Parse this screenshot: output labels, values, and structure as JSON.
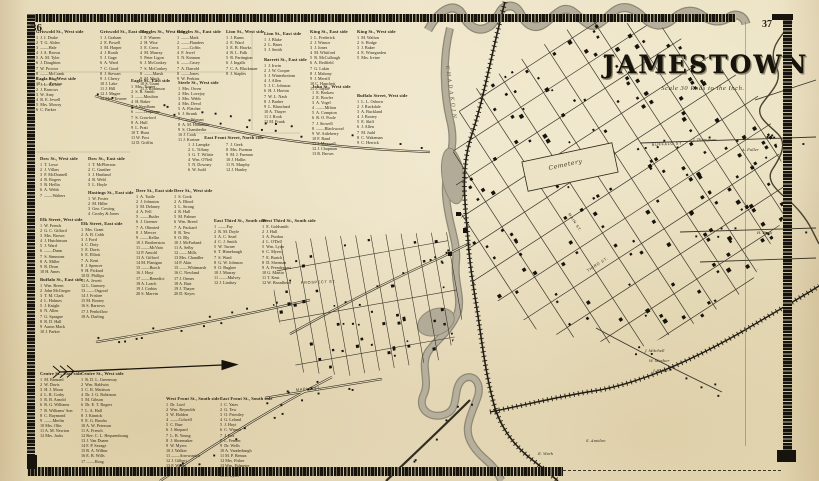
{
  "page": {
    "left_number": "36",
    "right_number": "37"
  },
  "title": {
    "text": "JAMESTOWN",
    "scale_note": "Scale 30 Rods to the Inch."
  },
  "map_labels": [
    {
      "text": "Cemetery",
      "x": 549,
      "y": 170,
      "rotate": -12,
      "cls": "cem"
    },
    {
      "text": "CHADAKOIN",
      "x": 446,
      "y": 66,
      "rotate": 82,
      "cls": "river"
    },
    {
      "text": "MAPLE  ST.",
      "x": 296,
      "y": 391,
      "rotate": -4,
      "cls": "street"
    },
    {
      "text": "PROSPECT  ST.",
      "x": 301,
      "y": 284,
      "rotate": -2,
      "cls": "street"
    },
    {
      "text": "MAIN  ST.",
      "x": 568,
      "y": 214,
      "rotate": 57,
      "cls": "street"
    },
    {
      "text": "THIRD  ST.",
      "x": 588,
      "y": 272,
      "rotate": -33,
      "cls": "street"
    },
    {
      "text": "BUFFALO  ST.",
      "x": 652,
      "y": 146,
      "rotate": -3,
      "cls": "street"
    }
  ],
  "settler_names": [
    {
      "text": "J. Thompson",
      "x": 693,
      "y": 141
    },
    {
      "text": "A. Fuller",
      "x": 742,
      "y": 151
    },
    {
      "text": "H. Bush",
      "x": 757,
      "y": 234
    },
    {
      "text": "J. Mitchell",
      "x": 645,
      "y": 352
    },
    {
      "text": "W. Mosher",
      "x": 649,
      "y": 362
    },
    {
      "text": "J. Baker",
      "x": 653,
      "y": 372
    },
    {
      "text": "S. Amidon",
      "x": 586,
      "y": 442
    },
    {
      "text": "E. Work",
      "x": 538,
      "y": 455
    }
  ],
  "directory": {
    "blocks": [
      {
        "header": "Griswold St., West side",
        "x": 36,
        "y": 29,
        "entries": [
          "1  J. J. Drake",
          "2  T. G. Alden",
          "3  ——Hale",
          "4  J. A. Brown",
          "5  A. M. Tyler",
          "6  J. Daughton",
          "7  W. Proctor",
          "8  ——McCrank",
          "9  ——King",
          "10 ——Preston"
        ]
      },
      {
        "header": "Griswold St., East side",
        "x": 100,
        "y": 29,
        "entries": [
          "1  J. Graham",
          "2  E. Powell",
          "3  M. Harper",
          "4  J. Roath",
          "5  J. Gage",
          "6  A. Ward",
          "7  C. Good",
          "8  J. Stewart",
          "9  J. Cherry",
          "10 J. Lake",
          "11 J. Hill",
          "12 J. Magee",
          "13 Mrs. Towner"
        ]
      },
      {
        "header": "Ruggles St., West side",
        "x": 140,
        "y": 29,
        "entries": [
          "1  F. Warren",
          "2  H. Wise",
          "3  E. Cross",
          "4  M. Murray",
          "5  Peter Ligon",
          "6  J. McConkey",
          "7  S. McConkey",
          "8  ——Marsh",
          "9  M. Mack",
          "10 S. Grant",
          "11 J. Robinson"
        ]
      },
      {
        "header": "Ruggles St., East side",
        "x": 177,
        "y": 29,
        "entries": [
          "1  ——Mark",
          "2  ——Flanders",
          "3  ——Coffin",
          "4  F. Jewel",
          "5  N. Kinman",
          "6  ——Casey",
          "7  A. Darrold",
          "8  ——Jones",
          "9  W. Perkins"
        ]
      },
      {
        "header": "Lion St., West side",
        "x": 226,
        "y": 29,
        "entries": [
          "1  J. Burns",
          "2  E. Ward",
          "3  E. B. Hawks",
          "4  R. L. Falk",
          "5  R. Partington",
          "6  J. Ingalls",
          "7  C. A. Blackmarr",
          "8  J. Staples"
        ]
      },
      {
        "header": "Lion St., East side",
        "x": 264,
        "y": 31,
        "entries": [
          "1  J. Blake",
          "2  L. Bates",
          "3  J. Smith"
        ]
      },
      {
        "header": "King St., East side",
        "x": 310,
        "y": 29,
        "entries": [
          "1  L. Frederick",
          "2  J. Winsor",
          "3  J. Jones",
          "4  M. Whitford",
          "5  R. McCullough",
          "6  A. Redfield",
          "7  G. Lakin",
          "8  J. Mahony",
          "9  J. Merrill",
          "10 C. Hanchett",
          "11 J. Taylor"
        ]
      },
      {
        "header": "King St., West side",
        "x": 357,
        "y": 29,
        "entries": [
          "1  M. Walton",
          "2  S. Hodge",
          "3  J. Baker",
          "4  E. Winegarden",
          "5  Mrs. Irvine"
        ]
      },
      {
        "header": "Eagle St., West side",
        "x": 36,
        "y": 76,
        "entries": [
          "1  J. L. Barlow",
          "2  J. Barrows",
          "3  W. Amy",
          "4  R. E. Jewell",
          "5  Mrs. Mowry",
          "6  C. Parker"
        ]
      },
      {
        "header": "Eagle St., East side",
        "x": 131,
        "y": 78,
        "entries": [
          "1  Mrs. Turner",
          "2  S. B. Smith",
          "3  ——Moulton",
          "4  H. Baker",
          "5  J. Needham",
          "6  ——Tenpenny",
          "7  S. Crawford",
          "8  A. Hull",
          "9  L. Pratt",
          "10 T. Hunt",
          "11 W. Post",
          "12 D. Griffin"
        ]
      },
      {
        "header": "Steele St., West side",
        "x": 178,
        "y": 80,
        "entries": [
          "1  Mrs. Owen",
          "2  Mrs. Lovejoy",
          "3  Mrs. Webb",
          "4  Mrs. Devol",
          "5  A. Fletcher",
          "6  J. Strunk",
          "7  ——Wyman",
          "8  A. M. Hamilton",
          "9  S. Chamberlin",
          "10 J. Cook",
          "11 J. Kortner"
        ]
      },
      {
        "header": "Barrett St., East side",
        "x": 264,
        "y": 57,
        "entries": [
          "1  J. Irwin",
          "2  J. W. Cooper",
          "3  J. Winterbottom",
          "4  J. Allen",
          "5  J. C. Johnson",
          "6  H. J. Horton",
          "7  W. L. Nash",
          "8  J. Barber",
          "9  L. Blanchard",
          "10 A. Thayer",
          "11 J. Rook",
          "12 M. Frank"
        ]
      },
      {
        "header": "John St., West side",
        "x": 312,
        "y": 84,
        "entries": [
          "1  E. Brokaw",
          "2  E. Bowler",
          "3  A. Vogel",
          "4  ——Milton",
          "5  A. Compton",
          "6  R. O. Poole",
          "7  J. Stowell",
          "8  ——Blackwood",
          "9  W. Attleberry",
          "10 F. Rand",
          "11 J. Maxwell",
          "12 J. Chapman",
          "13 R. Brown"
        ]
      },
      {
        "header": "Buffalo Street, West side",
        "x": 357,
        "y": 93,
        "w": 62,
        "entries": [
          "1  L. L. Osborn",
          "2  J. Ruckdale",
          "3  A. Buckland",
          "4  J. Bootey",
          "5  E. Skiff",
          "6  J. Allen",
          "7  M. Judd",
          "8  C. Wakeman",
          "9  C. Herrick"
        ]
      },
      {
        "header": "East Front Street, North side",
        "x": 184,
        "y": 135,
        "w": 100,
        "center": true,
        "entries": []
      },
      {
        "header": "",
        "x": 188,
        "y": 142,
        "entries": [
          "1  J. Lampke",
          "2  L. Tiffany",
          "3  G. T. Wiltsie",
          "4  Wm. O'Neil",
          "5  N. Downey",
          "6  W. Judd"
        ]
      },
      {
        "header": "",
        "x": 226,
        "y": 142,
        "entries": [
          "7  J. Geek",
          "8  Mrs. Furman",
          "9  M. J. Furman",
          "10 J. Hallin",
          "11 N. Murphy",
          "12 J. Hanley"
        ]
      },
      {
        "header": "Dow St., West side",
        "x": 40,
        "y": 156,
        "entries": [
          "1  T. Lowe",
          "2  J. Villars",
          "3  F. McDonnell",
          "4  R. Rogers",
          "5  B. Heflin",
          "6  A. Webb",
          "7  ——Walters"
        ]
      },
      {
        "header": "Dow St., East side",
        "x": 88,
        "y": 156,
        "entries": [
          "1  T. McPherson",
          "2  C. Gunther",
          "3  J. Hartland",
          "4  R. Weld",
          "5  L. Hoyle"
        ]
      },
      {
        "header": "Hastings St., East side",
        "x": 88,
        "y": 190,
        "entries": [
          "1  W. Foster",
          "2  M. Hiller",
          "3  Geo. Cowing",
          "4  Crosby & Jones"
        ]
      },
      {
        "header": "Deer St., East side",
        "x": 136,
        "y": 188,
        "entries": [
          "1  A. Tuttle",
          "2  J. Johnston",
          "3  M. Delaney",
          "4  A. Fell",
          "5  ——Butler",
          "6  J. Greener",
          "7  A. Olmsted",
          "8  J. Mercer",
          "9  ——Kellar",
          "10 J. Brotherston",
          "11 ——McVain",
          "12 P. Arnold",
          "13 A. Gifford",
          "14 M. Flanigan",
          "15 ——Burch",
          "16 J. Hoyt",
          "17 ——Benedict",
          "18 A. Leach",
          "19 J. Corbin",
          "20 S. Marvin"
        ]
      },
      {
        "header": "Deer St., West side",
        "x": 174,
        "y": 188,
        "entries": [
          "1  S. Cook",
          "2  A. Blood",
          "3  L. Strong",
          "4  R. Hall",
          "5  M. Palmer",
          "6  Wm. Breed",
          "7  A. Packard",
          "8  B. Tew",
          "9  O. Bly",
          "10 J. McFarland",
          "11 A. Selby",
          "12 ——Mills",
          "13 Mrs. Chandler",
          "14 P. Akin",
          "15 ——Whitmarsh",
          "16 C. Newland",
          "17 J. Ormes",
          "18 A. Burt",
          "19 J. Thayer",
          "20 D. Keyes"
        ]
      },
      {
        "header": "Elk Street, West side",
        "x": 40,
        "y": 217,
        "entries": [
          "1  W. French",
          "2  G. C. Gifford",
          "3  Mrs. Brown",
          "4  J. Hutchinson",
          "5  J. Ward",
          "6  ——Dunn",
          "7  S. Simmons",
          "8  A. Miller",
          "9  R. Dean",
          "10 H. Ames"
        ]
      },
      {
        "header": "Elk Street, East side",
        "x": 81,
        "y": 221,
        "entries": [
          "1  Mrs. Grant",
          "2  A. B. Cobb",
          "3  J. Ford",
          "4  C. Doty",
          "5  E. Davis",
          "6  E. Elliott",
          "7  A. Kent",
          "8  J. Spencer",
          "9  H. Pickard",
          "10 D. Phillips",
          "11 A. Jewett",
          "12 L. Gurnsey",
          "13 ——Osgood",
          "14 J. Frisbee",
          "15 M. Bootey",
          "16 S. Barrows",
          "17 J. Penhollow",
          "18 A. Darling"
        ]
      },
      {
        "header": "Buffalo St., East side",
        "x": 40,
        "y": 277,
        "entries": [
          "1  Wm. Breen",
          "2  John McGregor",
          "3  T. M. Clark",
          "4  L. Holmes",
          "5  J. Knight",
          "6  N. Allen",
          "7  G. Sprague",
          "8  R. D. Hall",
          "9  Aaron Mack",
          "10 J. Parker"
        ]
      },
      {
        "header": "East Third St., South side",
        "x": 214,
        "y": 218,
        "w": 62,
        "entries": [
          "1  ——Fay",
          "2  R. M. Doyle",
          "3  A. C. Searl",
          "4  C. J. Smith",
          "5  W. Turner",
          "6  T. Himebaugh",
          "7  S. Ward",
          "8  G. W. Johnson",
          "9  O. Bugbee",
          "10 J. Murray",
          "11 ——Mulvey",
          "12 J. Lindsey"
        ]
      },
      {
        "header": "West Third St., South side",
        "x": 262,
        "y": 218,
        "w": 62,
        "entries": [
          "1  E. Goldsmith",
          "2  J. Hull",
          "3  A. Purdon",
          "4  L. O'Dell",
          "5  Wm. Lyon",
          "6  C. Myers",
          "7  E. Burtch",
          "8  D. Sherman",
          "9  A. Prendergast",
          "10 G. Martin",
          "11 T. Kent",
          "12 W. Broadhead"
        ]
      },
      {
        "header": "Centre St., East side",
        "x": 40,
        "y": 371,
        "entries": [
          "1  M. Barnard",
          "2  W. Davis",
          "3  H. J. Moon",
          "4  L. R. Corby",
          "5  R. B. Arnold",
          "6  R. G. Williams",
          "7  R. Williams' Son",
          "8  C. Raymond",
          "9  ——Merlin",
          "10 Mrs. Olin",
          "11 A. M. Newton",
          "12 Mrs. Jacks"
        ]
      },
      {
        "header": "Centre St., West side",
        "x": 81,
        "y": 371,
        "entries": [
          "1  R. D. L. Greenway",
          "2  Wm. Baldwin",
          "3  C. R. Mattison",
          "4  Dr. J. G. Robinson",
          "5  M. Gibson",
          "6  Dr. E. T. Rogers",
          "7  L. A. Hall",
          "8  J. Kinnick",
          "9  E. G. Brooks",
          "10 A. W. Peterson",
          "11 A. French",
          "12 Rev. C. L. Hequembourg",
          "13 J. Van Duzen",
          "14 F. P. Savage",
          "15 R. A. Wilbur",
          "16 E. B. Wills",
          "17 ——Hoag"
        ]
      },
      {
        "header": "West Front St., South side",
        "x": 166,
        "y": 396,
        "w": 62,
        "entries": [
          "1  Dr. Lord",
          "2  Wm. Reynolds",
          "3  W. Holden",
          "4  ——Colwell",
          "5  C. Burr",
          "6  J. Shepard",
          "7  L. B. Young",
          "8  J. Shoemaker",
          "9  W. Myers",
          "10 J. Walker",
          "11 ——Arrowsmith",
          "12 J. Gilbert",
          "13 F. Weeks",
          "14 E. Jones"
        ]
      },
      {
        "header": "East Front St., South side",
        "x": 220,
        "y": 396,
        "w": 62,
        "entries": [
          "1  C. Yates",
          "2  G. Tew",
          "3  O. Priestley",
          "4  G. Leland",
          "5  J. Hoyt",
          "6  C. Winsor",
          "7  J. Fox",
          "8  L. Fenton",
          "9  Dr. Wells",
          "10 A. Vanderburgh",
          "11 M. P. Bemus",
          "12 Mrs. Fisher",
          "13 Wm. Palmeter",
          "14 A. C. Scofield",
          "15 E. Ryan"
        ]
      }
    ]
  }
}
